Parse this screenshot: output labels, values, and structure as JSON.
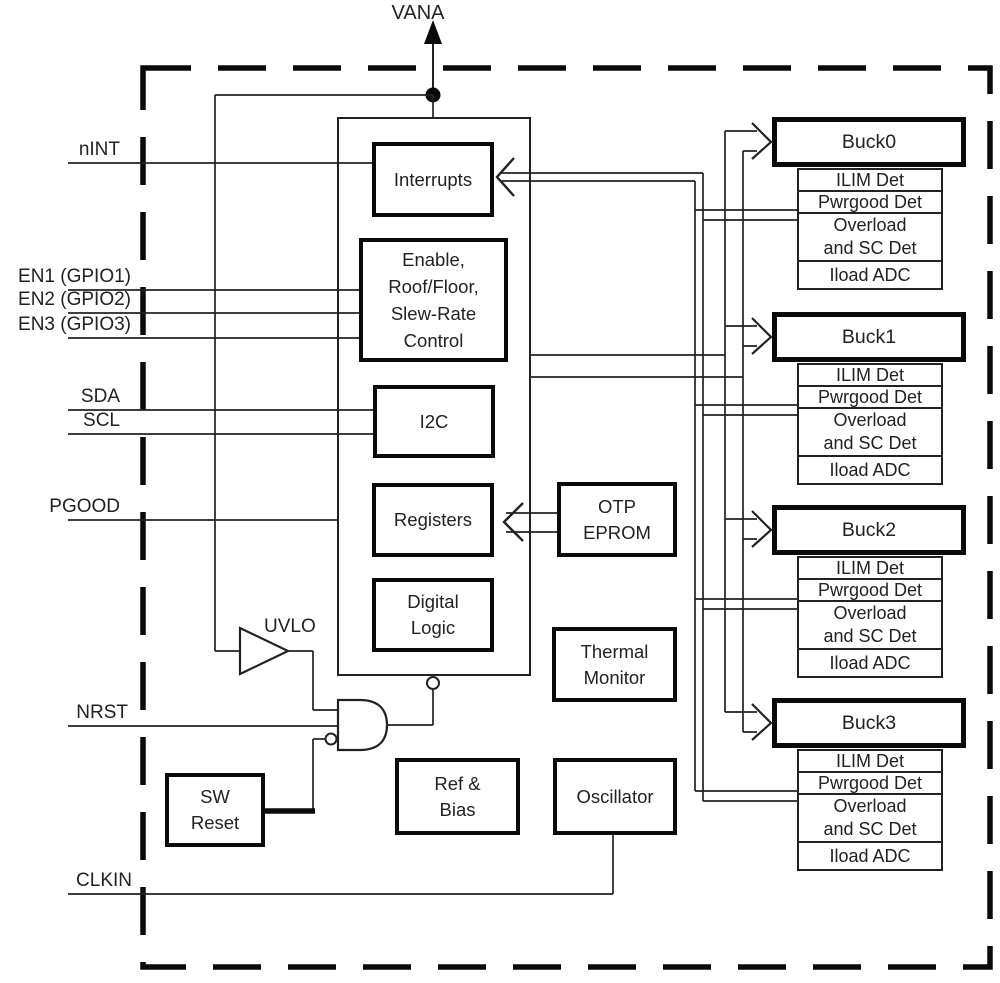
{
  "colors": {
    "line": "#0a0a0a",
    "text": "#222222",
    "background": "#ffffff"
  },
  "labels": {
    "vana": "VANA",
    "uvlo": "UVLO"
  },
  "pins": {
    "nint": "nINT",
    "en1": "EN1 (GPIO1)",
    "en2": "EN2 (GPIO2)",
    "en3": "EN3 (GPIO3)",
    "sda": "SDA",
    "scl": "SCL",
    "pgood": "PGOOD",
    "nrst": "NRST",
    "clkin": "CLKIN"
  },
  "blocks": {
    "interrupts": "Interrupts",
    "enable": [
      "Enable,",
      "Roof/Floor,",
      "Slew-Rate",
      "Control"
    ],
    "i2c": "I2C",
    "registers": "Registers",
    "digital_logic": [
      "Digital",
      "Logic"
    ],
    "otp_eprom": [
      "OTP",
      "EPROM"
    ],
    "thermal_monitor": [
      "Thermal",
      "Monitor"
    ],
    "ref_bias": [
      "Ref &",
      "Bias"
    ],
    "oscillator": "Oscillator",
    "sw_reset": [
      "SW",
      "Reset"
    ]
  },
  "bucks": [
    {
      "title": "Buck0",
      "rows": [
        "ILIM Det",
        "Pwrgood Det",
        "Overload and SC Det",
        "Iload ADC"
      ]
    },
    {
      "title": "Buck1",
      "rows": [
        "ILIM Det",
        "Pwrgood Det",
        "Overload and SC Det",
        "Iload ADC"
      ]
    },
    {
      "title": "Buck2",
      "rows": [
        "ILIM Det",
        "Pwrgood Det",
        "Overload and SC Det",
        "Iload ADC"
      ]
    },
    {
      "title": "Buck3",
      "rows": [
        "ILIM Det",
        "Pwrgood Det",
        "Overload and SC Det",
        "Iload ADC"
      ]
    }
  ]
}
